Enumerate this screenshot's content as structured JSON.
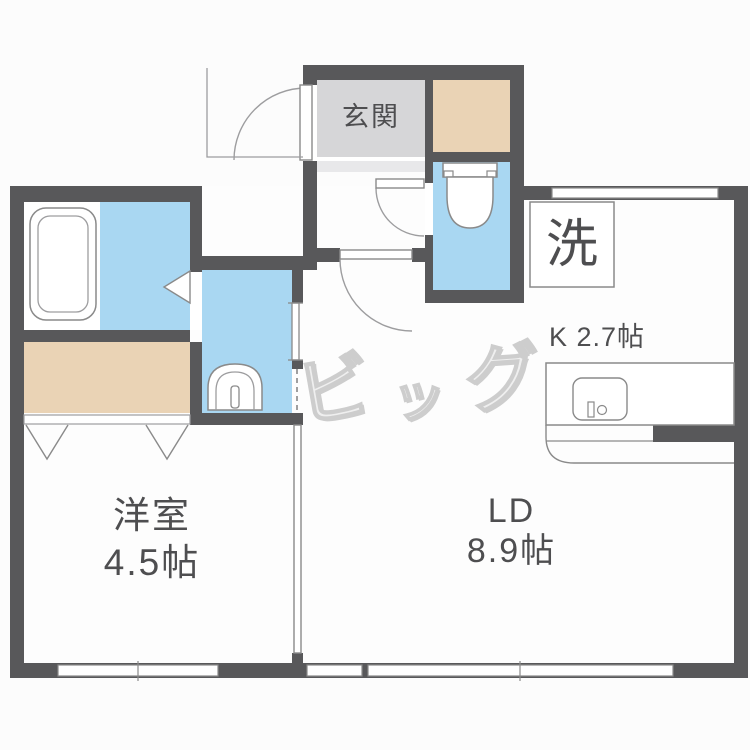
{
  "colors": {
    "wall": "#58585a",
    "water_blue": "#a9d7f2",
    "closet_beige": "#ead3b5",
    "entrance_gray": "#d6d6d8",
    "entrance_step": "#e8e8ea",
    "outline": "#8a8a8a",
    "outline_light": "#9d9d9f",
    "label": "#4e4e50",
    "watermark": "#efefef",
    "watermark_stroke": "#cdcdcd"
  },
  "labels": {
    "entrance": "玄関",
    "washer": "洗",
    "kitchen": "K 2.7帖",
    "living_line1": "LD",
    "living_line2": "8.9帖",
    "bedroom_line1": "洋室",
    "bedroom_line2": "4.5帖"
  },
  "watermark": {
    "chars": [
      "ビ",
      "ッ",
      "グ"
    ]
  }
}
